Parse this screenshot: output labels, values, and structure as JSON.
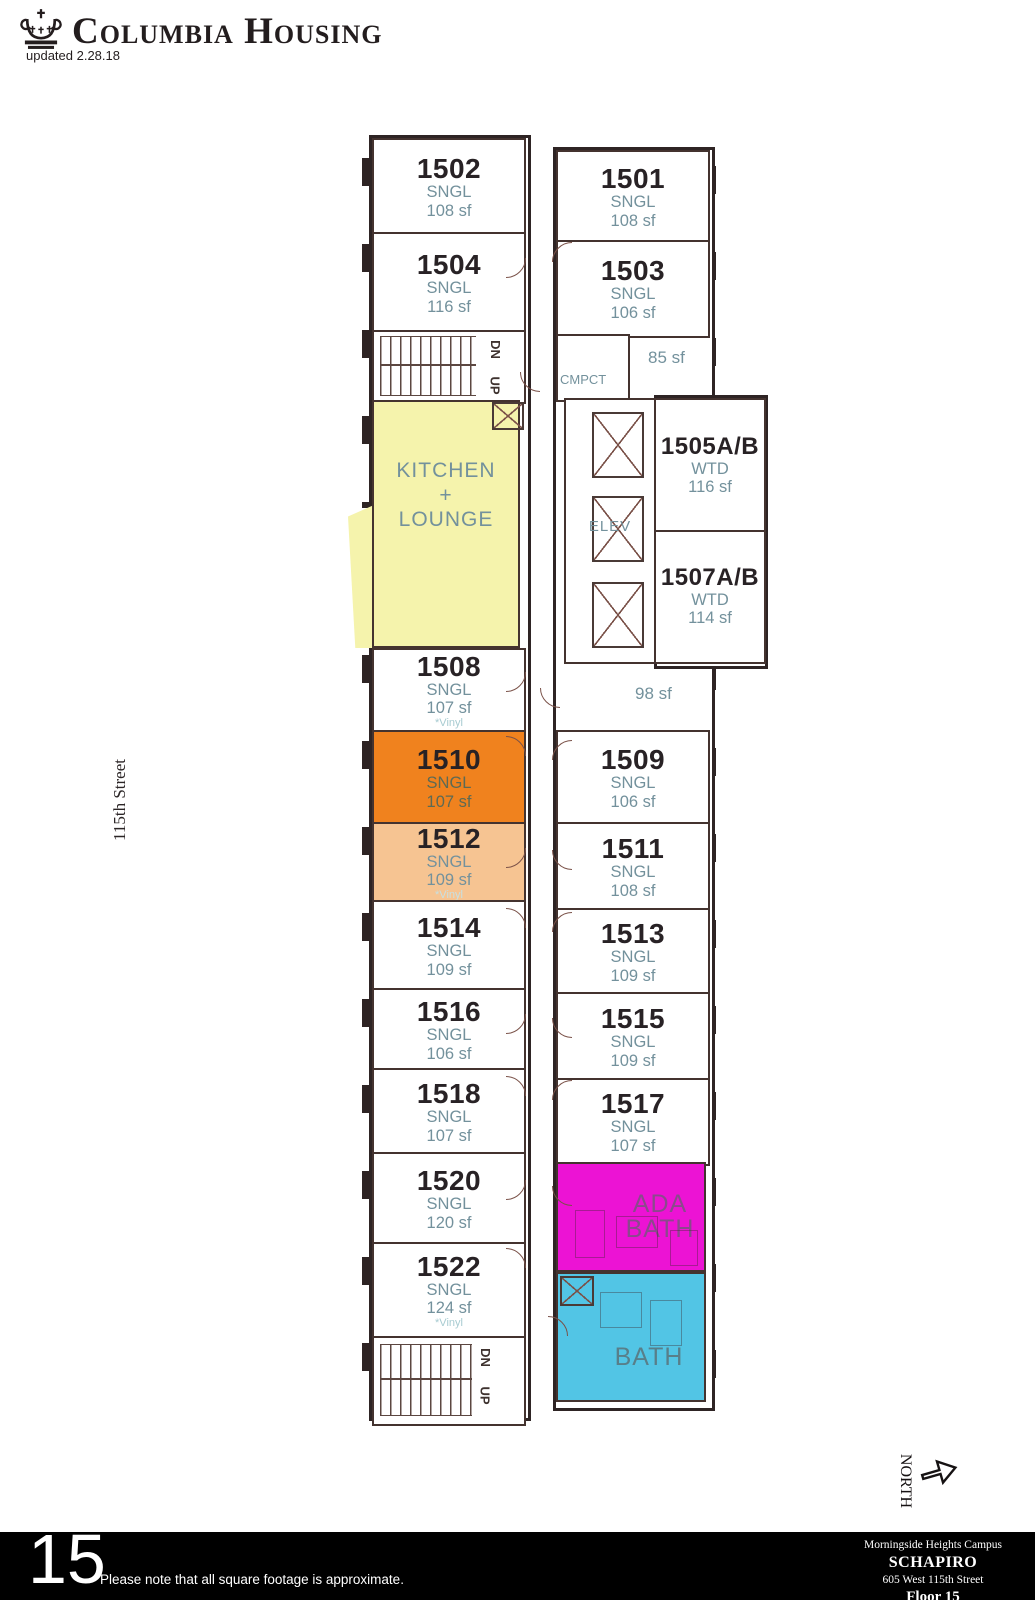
{
  "header": {
    "brand": "Columbia Housing",
    "updated": "updated 2.28.18"
  },
  "side": {
    "street": "115th Street",
    "north": "NORTH"
  },
  "plan": {
    "left_rooms": [
      {
        "number": "1502",
        "type": "SNGL",
        "area": "108 sf",
        "note": ""
      },
      {
        "number": "1504",
        "type": "SNGL",
        "area": "116 sf",
        "note": ""
      },
      {
        "number": "1508",
        "type": "SNGL",
        "area": "107 sf",
        "note": "*Vinyl"
      },
      {
        "number": "1510",
        "type": "SNGL",
        "area": "107 sf",
        "note": ""
      },
      {
        "number": "1512",
        "type": "SNGL",
        "area": "109 sf",
        "note": "*Vinyl"
      },
      {
        "number": "1514",
        "type": "SNGL",
        "area": "109 sf",
        "note": ""
      },
      {
        "number": "1516",
        "type": "SNGL",
        "area": "106 sf",
        "note": ""
      },
      {
        "number": "1518",
        "type": "SNGL",
        "area": "107 sf",
        "note": ""
      },
      {
        "number": "1520",
        "type": "SNGL",
        "area": "120 sf",
        "note": ""
      },
      {
        "number": "1522",
        "type": "SNGL",
        "area": "124 sf",
        "note": "*Vinyl"
      }
    ],
    "right_rooms": [
      {
        "number": "1501",
        "type": "SNGL",
        "area": "108 sf"
      },
      {
        "number": "1503",
        "type": "SNGL",
        "area": "106 sf"
      },
      {
        "number": "1505A/B",
        "type": "WTD",
        "area": "116 sf"
      },
      {
        "number": "1507A/B",
        "type": "WTD",
        "area": "114 sf"
      },
      {
        "number": "1509",
        "type": "SNGL",
        "area": "106 sf"
      },
      {
        "number": "1511",
        "type": "SNGL",
        "area": "108 sf"
      },
      {
        "number": "1513",
        "type": "SNGL",
        "area": "109 sf"
      },
      {
        "number": "1515",
        "type": "SNGL",
        "area": "109 sf"
      },
      {
        "number": "1517",
        "type": "SNGL",
        "area": "107 sf"
      }
    ],
    "labels": {
      "kitchen_line1": "KITCHEN",
      "kitchen_line2": "+",
      "kitchen_line3": "LOUNGE",
      "elev": "ELEV",
      "cmpct": "CMPCT",
      "sf85": "85 sf",
      "sf98": "98 sf",
      "dn": "DN",
      "up": "UP",
      "ada_line1": "ADA",
      "ada_line2": "BATH",
      "bath": "BATH"
    },
    "colors": {
      "kitchen_lounge": "#F5F3AC",
      "room_1510": "#F0821E",
      "room_1512": "#F6C492",
      "ada_bath": "#EC13D4",
      "bath": "#52C5E5",
      "wall": "#2e2424",
      "label_teal": "#73919c"
    }
  },
  "footer": {
    "floor_number": "15",
    "note": "Please note that all square footage is approximate.",
    "campus": "Morningside Heights Campus",
    "building": "SCHAPIRO",
    "address": "605 West 115th Street",
    "floor_label": "Floor 15"
  }
}
